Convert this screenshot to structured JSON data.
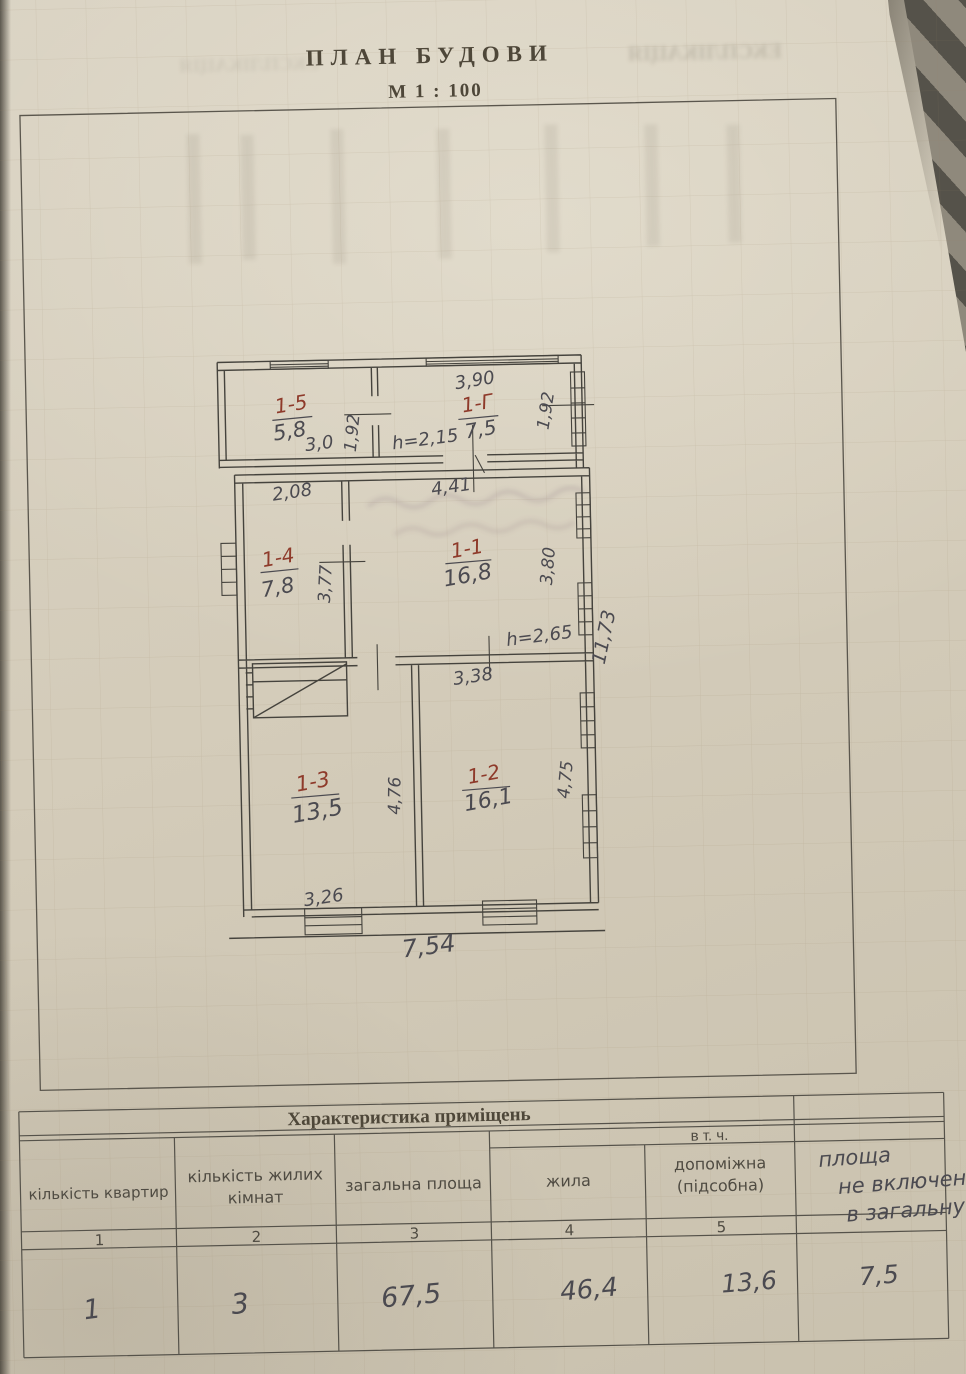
{
  "page": {
    "title": "ПЛАН БУДОВИ",
    "scale": "М 1 : 100",
    "bleedthrough_text": "ЕКСПЛІКАЦІЯ"
  },
  "colors": {
    "paper": "#d3cbb9",
    "ink": "#45433d",
    "pencil": "#4b4a50",
    "red_ink": "#8e3a2a",
    "fabric_dark": "#55524a",
    "fabric_light": "#8f897c"
  },
  "plan": {
    "rooms": [
      {
        "code": "1-5",
        "area": "5,8"
      },
      {
        "code": "1-Г",
        "area": "7,5"
      },
      {
        "code": "1-4",
        "area": "7,8"
      },
      {
        "code": "1-1",
        "area": "16,8"
      },
      {
        "code": "1-3",
        "area": "13,5"
      },
      {
        "code": "1-2",
        "area": "16,1"
      }
    ],
    "dims": {
      "annex_top_width": "3,90",
      "annex_left_height": "1,92",
      "annex_right_height": "1,92",
      "room15_width": "3,0",
      "annex_ceiling_height": "h=2,15",
      "room14_top_width": "2,08",
      "room11_top_width": "4,41",
      "room14_side_height": "3,77",
      "room11_side_height": "3,80",
      "main_ceiling_height": "h=2,65",
      "house_right_depth": "11,73",
      "room12_top_width": "3,38",
      "room13_side_height": "4,76",
      "room12_side_height": "4,75",
      "room13_bottom_width": "3,26",
      "house_bottom_width": "7,54"
    }
  },
  "table": {
    "title": "Характеристика  приміщень",
    "including_label": "в т. ч.",
    "columns": [
      {
        "header_lines": [
          "кількість квартир"
        ],
        "number": "1",
        "value": "1"
      },
      {
        "header_lines": [
          "кількість жилих",
          "кімнат"
        ],
        "number": "2",
        "value": "3"
      },
      {
        "header_lines": [
          "загальна площа"
        ],
        "number": "3",
        "value": "67,5"
      },
      {
        "header_lines": [
          "жила"
        ],
        "number": "4",
        "value": "46,4"
      },
      {
        "header_lines": [
          "допоміжна",
          "(підсобна)"
        ],
        "number": "5",
        "value": "13,6"
      },
      {
        "header_lines": [
          "площа",
          "не включен",
          "в загальну"
        ],
        "number": "",
        "value": "7,5"
      }
    ]
  }
}
